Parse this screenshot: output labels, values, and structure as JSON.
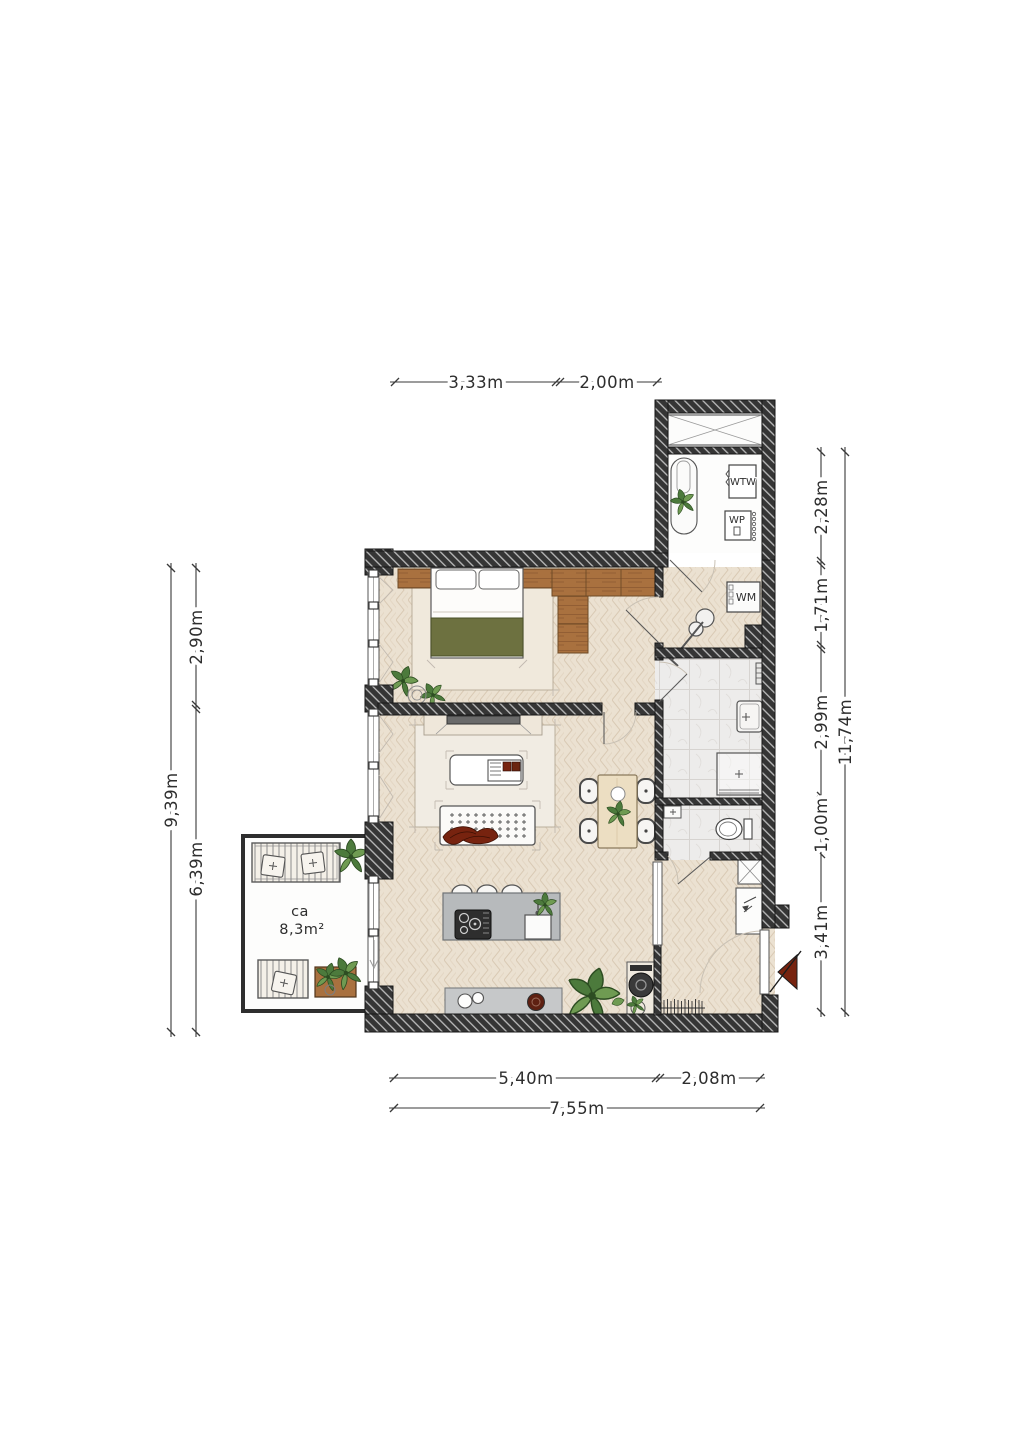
{
  "plan": {
    "balcony": {
      "line1": "ca",
      "line2": "8,3m²"
    },
    "labels": {
      "wtw": "WTW",
      "wp": "WP",
      "wm": "WM"
    },
    "dims": {
      "top": [
        "3,33m",
        "2,00m"
      ],
      "bottom": [
        "5,40m",
        "2,08m"
      ],
      "bottom_total": "7,55m",
      "left": [
        "2,90m",
        "6,39m"
      ],
      "left_total": "9,39m",
      "right": [
        "2,28m",
        "1,71m",
        "2,99m",
        "1,00m",
        "3,41m"
      ],
      "right_total": "11,74m"
    },
    "colors": {
      "wall": "#353535",
      "wood": "#a9713f",
      "blanket": "#6d7140",
      "accent_red": "#77230f",
      "floor": "#ebe1d1",
      "tile": "#edeceb",
      "kitchen_gray": "#b7babc",
      "plant_green": "#4c7a3c"
    }
  }
}
